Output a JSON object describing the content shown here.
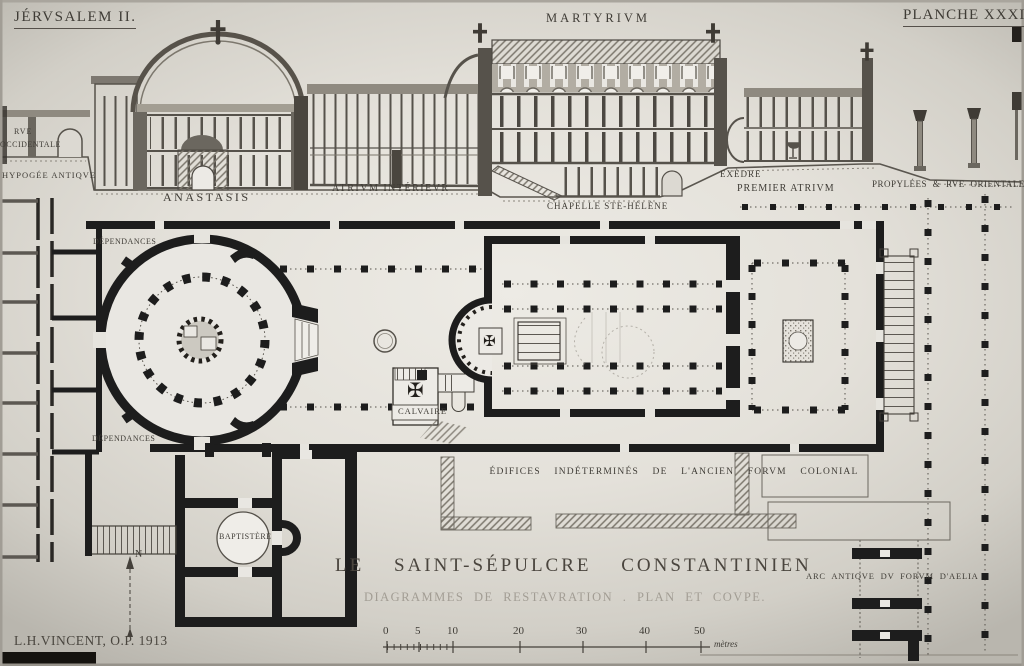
{
  "plate": {
    "series": "JÉRVSALEM II.",
    "number": "PLANCHE XXXII"
  },
  "icons": {
    "maltese_cross": "✠"
  },
  "compass": {
    "north": "N"
  },
  "section_labels": {
    "martyrium": "MARTYRIVM",
    "rue_line1": "RVE",
    "rue_line2": "OCCIDENTALE",
    "hypogee": "HYPOGÉE ANTIQVE",
    "anastasis": "ANASTASIS",
    "atrium_interieur": "ATRIVM INTÉRIEVR",
    "chapelle": "CHAPELLE STE-HÉLÈNE",
    "exedre": "EXÈDRE",
    "premier_atrium": "PREMIER ATRIVM",
    "propylees": "PROPYLÉES & RVE ORIENTALE"
  },
  "plan_labels": {
    "dependances_nord": "DÉPENDANCES",
    "dependances_sud": "DÉPENDANCES",
    "calvaire": "CALVAIRE",
    "baptistere": "BAPTISTÈRE",
    "edifices": "ÉDIFICES INDÉTERMINÉS DE L'ANCIEN FORVM COLONIAL",
    "arc_antique": "ARC ANTIQVE DV FORVM D'AELIA"
  },
  "titleblock": {
    "title": "LE SAINT-SÉPULCRE CONSTANTINIEN",
    "subtitle": "DIAGRAMMES DE RESTAVRATION . PLAN ET COVPE.",
    "signature": "L.H.VINCENT, O.P. 1913"
  },
  "scalebar": {
    "ticks": [
      "0",
      "5",
      "10",
      "20",
      "30",
      "40",
      "50"
    ],
    "unit": "mètres"
  }
}
